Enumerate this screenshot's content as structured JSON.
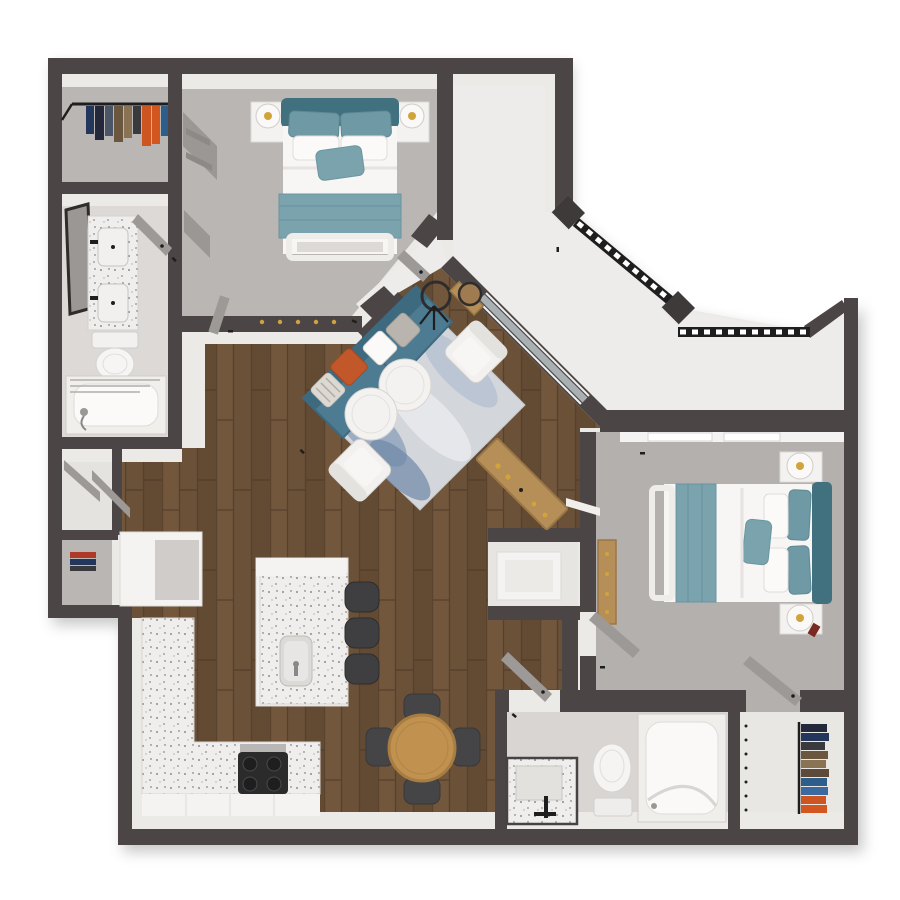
{
  "meta": {
    "view": "3d-top-down-floor-plan-render",
    "bedrooms": 2,
    "bathrooms": 2,
    "background": "#ffffff"
  },
  "palette": {
    "wall": "#4b4545",
    "wall_dark": "#3f3a3a",
    "wall_face": "#eceae7",
    "carpet": "#b9b6b3",
    "carpet2": "#b3b0ad",
    "tile": "#dcd9d6",
    "tile2": "#d8d5d2",
    "concrete": "#edecea",
    "nook_floor": "#e7e5e2",
    "closet_floor": "#e9e7e4",
    "hall_floor": "#e5e3e0",
    "wood": "#6b5138",
    "wood_light": "#7a5e40",
    "wood_dark": "#59432d",
    "wood_line": "#4e3b28",
    "counter": "#efeeec",
    "speckle": "#8f8d8a",
    "cabinet": "#f4f3f1",
    "cabinet_shade": "#cfccc9",
    "teal_dark": "#41707e",
    "teal": "#6f99a4",
    "teal_light": "#7ba3ad",
    "sofa": "#4d7b92",
    "sofa_dark": "#3e6a80",
    "orange": "#c2572a",
    "rug": "#d3d6da",
    "rug_blue": "#8fa3bd",
    "rug_blue_dark": "#6f87a8",
    "rug_pale": "#e8e9ec",
    "rug_light_blue": "#b9c3d2",
    "white_furn": "#f2f1ef",
    "bed_white": "#f7f6f4",
    "pillow_white": "#fbfaf9",
    "bench": "#efedea",
    "chair_dark": "#454547",
    "stool_dark": "#3f3f41",
    "table_wood": "#c0914f",
    "table_wood_dark": "#a87d42",
    "console_wood": "#b68f58",
    "console_dark": "#9a7746",
    "black": "#1f1e1e",
    "gold": "#d1a33c",
    "glass": "#a9b0b3",
    "door": "#9d9997",
    "metal": "#b9b7b5",
    "appliance": "#2b2b2c",
    "decor_red": "#7a2a22",
    "pillow_gray": "#b9b5ae",
    "pillow_stripe": "#dcd9d3",
    "cloth_navy": "#23293a",
    "cloth_slate": "#4a5668",
    "cloth_brown": "#5d4a38",
    "cloth_brown2": "#6b5640",
    "cloth_tan": "#8a7355",
    "cloth_dark": "#3a3a3e",
    "cloth_orange": "#cc5522",
    "cloth_orange2": "#d4561f",
    "cloth_blue": "#2f5d8a",
    "cloth_navy2": "#23375c",
    "cloth_blue2": "#3a6aa0",
    "cloth_red": "#b03a2a",
    "mirror_frame": "#2e2d2c"
  },
  "rooms": [
    {
      "name": "walk-in-closet-1",
      "floor": "carpet"
    },
    {
      "name": "bathroom-1",
      "floor": "tile"
    },
    {
      "name": "bedroom-1",
      "floor": "carpet"
    },
    {
      "name": "entry",
      "floor": "concrete"
    },
    {
      "name": "balcony",
      "floor": "concrete"
    },
    {
      "name": "living-room",
      "floor": "wood"
    },
    {
      "name": "dining-area",
      "floor": "wood"
    },
    {
      "name": "kitchen",
      "floor": "wood"
    },
    {
      "name": "hallway",
      "floor": "wood"
    },
    {
      "name": "laundry-closet",
      "floor": "carpet"
    },
    {
      "name": "desk-nook",
      "floor": "tile"
    },
    {
      "name": "bedroom-2",
      "floor": "carpet"
    },
    {
      "name": "bathroom-2",
      "floor": "tile"
    },
    {
      "name": "walk-in-closet-2",
      "floor": "tile"
    }
  ],
  "furniture": [
    "queen-bed-teal-1",
    "nightstands-with-lamps-1",
    "sliding-closet-doors",
    "double-vanity",
    "toilet-1",
    "tub-shower-1",
    "framed-mirror",
    "hanging-clothes-rod-1",
    "teal-sofa",
    "accent-pillows",
    "area-rug",
    "round-coffee-tables",
    "white-armchairs",
    "arc-floor-lamp",
    "wood-console-table",
    "entry-console-with-round-mirror",
    "kitchen-l-counter",
    "kitchen-island-with-sink",
    "bar-stools-3",
    "gas-cooktop",
    "fridge-pantry-unit",
    "round-dining-table",
    "dining-chairs-4",
    "desk",
    "dresser",
    "queen-bed-teal-2",
    "nightstands-with-lamps-2",
    "vanity-2",
    "toilet-2",
    "tub-shower-2",
    "hanging-clothes-rod-2",
    "balcony-railings",
    "railing-posts"
  ]
}
